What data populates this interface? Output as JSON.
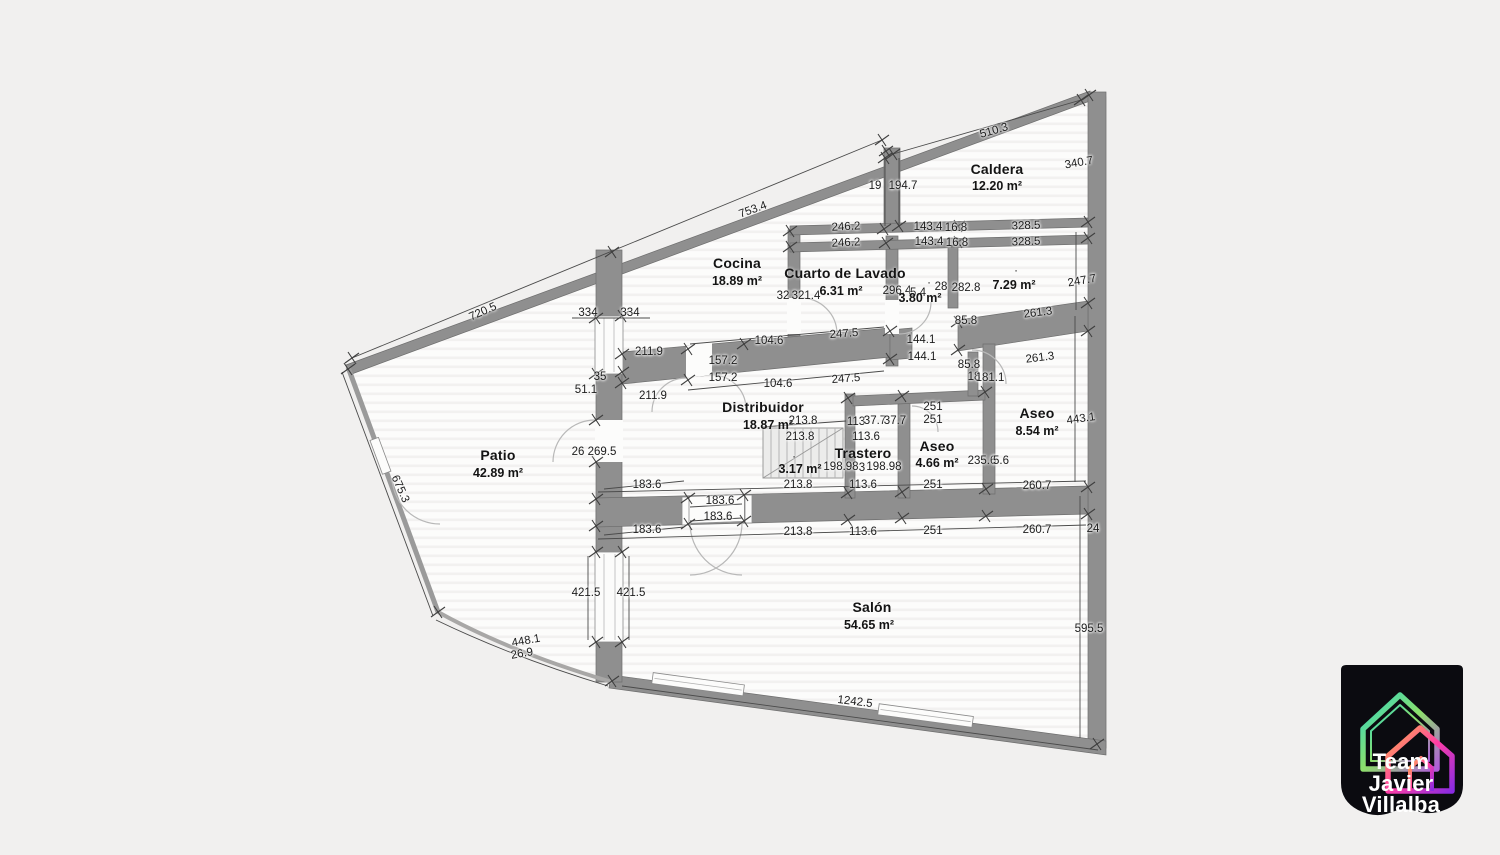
{
  "page": {
    "background": "#f1f0ef"
  },
  "plan": {
    "rooms": [
      {
        "name": "Caldera",
        "area": "12.20 m²",
        "nx": 997,
        "ny": 169,
        "ax": 997,
        "ay": 186
      },
      {
        "name": "Cocina",
        "area": "18.89 m²",
        "nx": 737,
        "ny": 263,
        "ax": 737,
        "ay": 281
      },
      {
        "name": "Cuarto de Lavado",
        "area": "6.31 m²",
        "nx": 845,
        "ny": 273,
        "ax": 841,
        "ay": 291
      },
      {
        "name": "",
        "area": "3.80 m²",
        "nx": 0,
        "ny": 0,
        "ax": 920,
        "ay": 298
      },
      {
        "name": "",
        "area": "7.29 m²",
        "nx": 0,
        "ny": 0,
        "ax": 1014,
        "ay": 285
      },
      {
        "name": "Distribuidor",
        "area": "18.87 m²",
        "nx": 763,
        "ny": 407,
        "ax": 768,
        "ay": 425
      },
      {
        "name": "Trastero",
        "area": "3.17 m²",
        "nx": 863,
        "ny": 453,
        "ax": 800,
        "ay": 469
      },
      {
        "name": "Aseo",
        "area": "4.66 m²",
        "nx": 937,
        "ny": 446,
        "ax": 937,
        "ay": 463
      },
      {
        "name": "Aseo",
        "area": "8.54 m²",
        "nx": 1037,
        "ny": 413,
        "ax": 1037,
        "ay": 431
      },
      {
        "name": "Patio",
        "area": "42.89 m²",
        "nx": 498,
        "ny": 455,
        "ax": 498,
        "ay": 473
      },
      {
        "name": "Salón",
        "area": "54.65 m²",
        "nx": 872,
        "ny": 607,
        "ax": 869,
        "ay": 625
      }
    ],
    "dimensions": [
      {
        "t": "720.5",
        "x": 483,
        "y": 312,
        "r": -24
      },
      {
        "t": "753.4",
        "x": 753,
        "y": 210,
        "r": -20
      },
      {
        "t": "510.3",
        "x": 994,
        "y": 131,
        "r": -16
      },
      {
        "t": "340.7",
        "x": 1079,
        "y": 163,
        "r": -10
      },
      {
        "t": "19",
        "x": 875,
        "y": 186
      },
      {
        "t": "194.7",
        "x": 903,
        "y": 186
      },
      {
        "t": "246.2",
        "x": 846,
        "y": 227,
        "r": -3
      },
      {
        "t": "246.2",
        "x": 846,
        "y": 243,
        "r": -3
      },
      {
        "t": "143.4",
        "x": 928,
        "y": 227
      },
      {
        "t": "16.8",
        "x": 956,
        "y": 228
      },
      {
        "t": "143.4",
        "x": 929,
        "y": 242
      },
      {
        "t": "16.8",
        "x": 957,
        "y": 243
      },
      {
        "t": "328.5",
        "x": 1026,
        "y": 226,
        "r": -2
      },
      {
        "t": "328.5",
        "x": 1026,
        "y": 242,
        "r": -2
      },
      {
        "t": "247.7",
        "x": 1082,
        "y": 281,
        "r": -10
      },
      {
        "t": "32",
        "x": 783,
        "y": 296
      },
      {
        "t": "321.4",
        "x": 806,
        "y": 296
      },
      {
        "t": "296.4",
        "x": 897,
        "y": 291
      },
      {
        "t": "5.4",
        "x": 918,
        "y": 293
      },
      {
        "t": "28",
        "x": 941,
        "y": 287
      },
      {
        "t": "282.8",
        "x": 966,
        "y": 288
      },
      {
        "t": "·",
        "x": 929,
        "y": 283
      },
      {
        "t": "·",
        "x": 1016,
        "y": 271
      },
      {
        "t": "·",
        "x": 794,
        "y": 457
      },
      {
        "t": "85.8",
        "x": 966,
        "y": 321
      },
      {
        "t": "261.3",
        "x": 1038,
        "y": 313,
        "r": -7
      },
      {
        "t": "261.3",
        "x": 1040,
        "y": 358,
        "r": -7
      },
      {
        "t": "85.8",
        "x": 969,
        "y": 365
      },
      {
        "t": "18",
        "x": 974,
        "y": 377
      },
      {
        "t": "181.1",
        "x": 990,
        "y": 378
      },
      {
        "t": "144.1",
        "x": 921,
        "y": 340
      },
      {
        "t": "144.1",
        "x": 922,
        "y": 357
      },
      {
        "t": "104.6",
        "x": 769,
        "y": 341
      },
      {
        "t": "247.5",
        "x": 844,
        "y": 334,
        "r": -4
      },
      {
        "t": "157.2",
        "x": 723,
        "y": 361
      },
      {
        "t": "157.2",
        "x": 723,
        "y": 378
      },
      {
        "t": "104.6",
        "x": 778,
        "y": 384
      },
      {
        "t": "247.5",
        "x": 846,
        "y": 379,
        "r": -4
      },
      {
        "t": "334",
        "x": 588,
        "y": 313
      },
      {
        "t": "334",
        "x": 630,
        "y": 313
      },
      {
        "t": "211.9",
        "x": 649,
        "y": 352
      },
      {
        "t": "35",
        "x": 600,
        "y": 377
      },
      {
        "t": "51.1",
        "x": 586,
        "y": 390
      },
      {
        "t": "211.9",
        "x": 653,
        "y": 396
      },
      {
        "t": "26",
        "x": 578,
        "y": 452
      },
      {
        "t": "269.5",
        "x": 602,
        "y": 452
      },
      {
        "t": "213.8",
        "x": 803,
        "y": 421
      },
      {
        "t": "113",
        "x": 856,
        "y": 422
      },
      {
        "t": "37.7",
        "x": 875,
        "y": 421
      },
      {
        "t": "37.7",
        "x": 895,
        "y": 421
      },
      {
        "t": "251",
        "x": 933,
        "y": 407
      },
      {
        "t": "251",
        "x": 933,
        "y": 420
      },
      {
        "t": "213.8",
        "x": 800,
        "y": 437
      },
      {
        "t": "113.6",
        "x": 866,
        "y": 437
      },
      {
        "t": "198.98",
        "x": 841,
        "y": 467
      },
      {
        "t": "3",
        "x": 862,
        "y": 468
      },
      {
        "t": "198.98",
        "x": 884,
        "y": 467
      },
      {
        "t": "235.6",
        "x": 982,
        "y": 461
      },
      {
        "t": "5.6",
        "x": 1001,
        "y": 461
      },
      {
        "t": "443.1",
        "x": 1081,
        "y": 419,
        "r": -8
      },
      {
        "t": "183.6",
        "x": 647,
        "y": 485
      },
      {
        "t": "183.6",
        "x": 720,
        "y": 501
      },
      {
        "t": "183.6",
        "x": 718,
        "y": 517
      },
      {
        "t": "183.6",
        "x": 647,
        "y": 530
      },
      {
        "t": "213.8",
        "x": 798,
        "y": 485
      },
      {
        "t": "113.6",
        "x": 863,
        "y": 485
      },
      {
        "t": "251",
        "x": 933,
        "y": 485
      },
      {
        "t": "260.7",
        "x": 1037,
        "y": 486
      },
      {
        "t": "213.8",
        "x": 798,
        "y": 532
      },
      {
        "t": "113.6",
        "x": 863,
        "y": 532
      },
      {
        "t": "251",
        "x": 933,
        "y": 531
      },
      {
        "t": "260.7",
        "x": 1037,
        "y": 530
      },
      {
        "t": "24",
        "x": 1093,
        "y": 529
      },
      {
        "t": "421.5",
        "x": 586,
        "y": 593
      },
      {
        "t": "421.5",
        "x": 631,
        "y": 593
      },
      {
        "t": "448.1",
        "x": 526,
        "y": 641,
        "r": -10
      },
      {
        "t": "26.9",
        "x": 522,
        "y": 654,
        "r": -10
      },
      {
        "t": "675.3",
        "x": 400,
        "y": 489,
        "r": 66
      },
      {
        "t": "595.5",
        "x": 1089,
        "y": 629
      },
      {
        "t": "1242.5",
        "x": 855,
        "y": 702,
        "r": 7
      }
    ]
  },
  "logo": {
    "lines": [
      "Team",
      "Javier",
      "Villalba"
    ],
    "badge_color": "#0b0b10",
    "text_color": "#ffffff",
    "gradient_a": [
      "#2fd6c3",
      "#8de06a",
      "#b05cd9"
    ],
    "gradient_b": [
      "#ffb347",
      "#ff3ea5",
      "#8a2be2"
    ]
  }
}
